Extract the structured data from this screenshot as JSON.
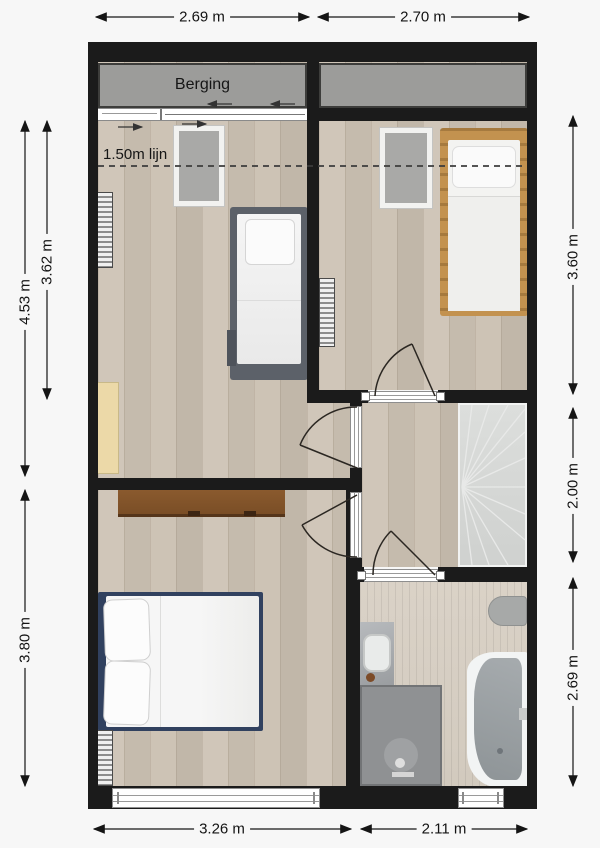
{
  "labels": {
    "storage_room": "Berging",
    "height_line": "1.50m lijn"
  },
  "dimensions": {
    "top_left": "2.69 m",
    "top_right": "2.70 m",
    "bottom_left": "3.26 m",
    "bottom_right": "2.11 m",
    "left_outer_upper": "4.53 m",
    "left_inner_upper": "3.62 m",
    "left_outer_lower": "3.80 m",
    "right_upper": "3.60 m",
    "right_middle": "2.00 m",
    "right_lower": "2.69 m"
  },
  "fixtures": [
    "storage-attic-left",
    "storage-attic-right",
    "sliding-door",
    "skylight-window",
    "skylight-window",
    "single-bed",
    "single-bed",
    "double-bed",
    "desk",
    "wardrobe",
    "radiator",
    "radiator",
    "radiator",
    "staircase",
    "toilet",
    "sink",
    "shower",
    "bathtub",
    "window",
    "window",
    "door",
    "door",
    "door",
    "door"
  ],
  "colors": {
    "wall": "#1b1b1b",
    "wood_floor": "#cbc1b3",
    "bathroom_tile": "#d6cec3",
    "storage_fill": "#9c9c9a",
    "storage_border": "#3d3d3b",
    "stair_fill": "#d6d8d6",
    "text": "#131313",
    "bed_frame_gray": "#5c6169",
    "bed_frame_wood": "#c3924f",
    "headboard_navy": "#31415f",
    "desk_brown": "#82552c",
    "cabinet_tan": "#ecd9a8",
    "fixture_gray": "#8f9193"
  }
}
